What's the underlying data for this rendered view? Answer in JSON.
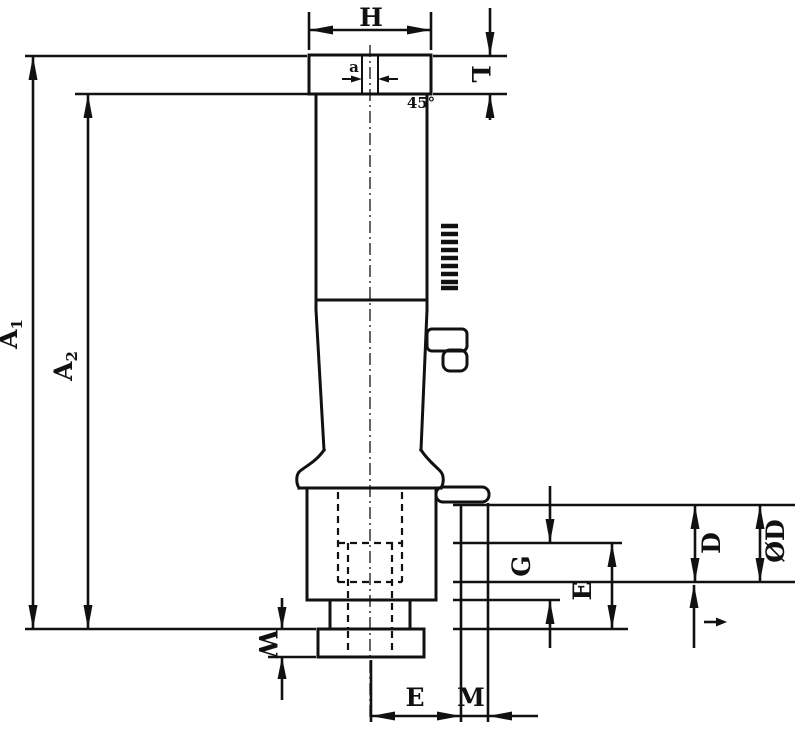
{
  "drawing": {
    "labels": {
      "h": "H",
      "l": "L",
      "a1": {
        "base": "A",
        "sub": "1"
      },
      "a2": {
        "base": "A",
        "sub": "2"
      },
      "w": "W",
      "g": "G",
      "e_side": "E",
      "d": "D",
      "od": "ØD",
      "e_bottom": "E",
      "m": "M",
      "slot_width": "a",
      "chamfer_angle": "45°"
    },
    "colors": {
      "line": "#111111",
      "background": "#ffffff"
    }
  }
}
